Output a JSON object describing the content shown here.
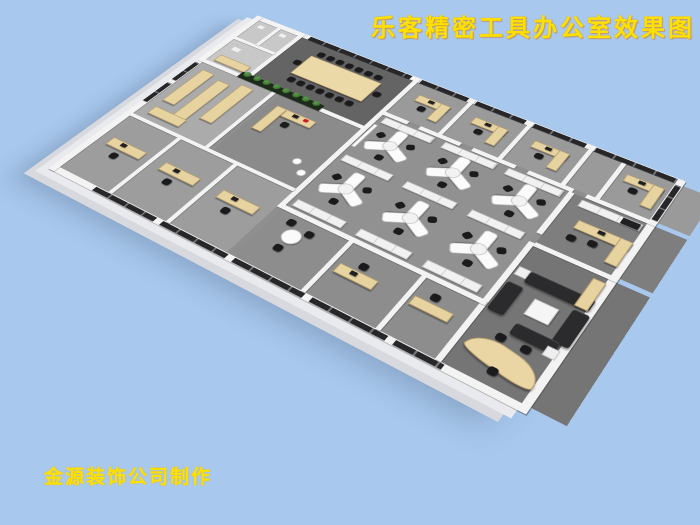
{
  "title": {
    "text": "乐客精密工具办公室效果图",
    "color": "#ffe100"
  },
  "credit": {
    "text": "金源装饰公司制作",
    "color": "#ffe100"
  },
  "palette": {
    "background": "#a8c8ed",
    "wall": "#f3f3f4",
    "floor": "#8f8f8f",
    "window_glass": "#27272a",
    "desk_wood": "#e7d3a0",
    "chair": "#1b1b1d",
    "sofa": "#2b2b2e",
    "plant_green": "#3f7d36",
    "accent_red": "#c81f1f",
    "text_yellow": "#ffe100"
  },
  "scene": {
    "rooms": [
      {
        "n": "restrooms",
        "x": 8,
        "y": 8,
        "w": 58,
        "h": 97,
        "c": "#c8c8c8"
      },
      {
        "n": "conference-room",
        "x": 72,
        "y": 8,
        "w": 153,
        "h": 97,
        "c": "#646464"
      },
      {
        "n": "ne-office-row",
        "x": 231,
        "y": 8,
        "w": 341,
        "h": 64,
        "c": "#9a9a9a"
      },
      {
        "n": "open-office",
        "x": 231,
        "y": 78,
        "w": 219,
        "h": 172,
        "c": "#919191"
      },
      {
        "n": "executive-office",
        "x": 456,
        "y": 78,
        "w": 116,
        "h": 82,
        "c": "#7e7e7e"
      },
      {
        "n": "lounge-reception",
        "x": 456,
        "y": 166,
        "w": 116,
        "h": 166,
        "c": "#757575"
      },
      {
        "n": "storage-room",
        "x": 8,
        "y": 111,
        "w": 100,
        "h": 114,
        "c": "#ababab"
      },
      {
        "n": "manager-office",
        "x": 118,
        "y": 111,
        "w": 107,
        "h": 114,
        "c": "#8b8b8b"
      },
      {
        "n": "sw-office-row",
        "x": 8,
        "y": 230,
        "w": 217,
        "h": 102,
        "c": "#9d9d9d"
      },
      {
        "n": "small-meeting-rooms",
        "x": 231,
        "y": 256,
        "w": 219,
        "h": 76,
        "c": "#8d8d8d"
      }
    ],
    "walls": [
      {
        "x": 0,
        "y": 0,
        "w": 540,
        "h": 8
      },
      {
        "x": 0,
        "y": 332,
        "w": 540,
        "h": 8
      },
      {
        "x": 0,
        "y": 0,
        "w": 8,
        "h": 340
      },
      {
        "x": 532,
        "y": 0,
        "w": 8,
        "h": 340
      },
      {
        "x": 66,
        "y": 0,
        "w": 6,
        "h": 105
      },
      {
        "x": 0,
        "y": 105,
        "w": 231,
        "h": 6
      },
      {
        "x": 225,
        "y": 0,
        "w": 6,
        "h": 256
      },
      {
        "x": 296,
        "y": 0,
        "w": 5,
        "h": 72
      },
      {
        "x": 367,
        "y": 0,
        "w": 5,
        "h": 72
      },
      {
        "x": 438,
        "y": 0,
        "w": 5,
        "h": 72
      },
      {
        "x": 475,
        "y": 0,
        "w": 5,
        "h": 72
      },
      {
        "x": 231,
        "y": 72,
        "w": 30,
        "h": 6
      },
      {
        "x": 275,
        "y": 72,
        "w": 50,
        "h": 6
      },
      {
        "x": 339,
        "y": 72,
        "w": 50,
        "h": 6
      },
      {
        "x": 403,
        "y": 72,
        "w": 50,
        "h": 6
      },
      {
        "x": 467,
        "y": 72,
        "w": 73,
        "h": 6
      },
      {
        "x": 450,
        "y": 78,
        "w": 6,
        "h": 70
      },
      {
        "x": 450,
        "y": 162,
        "w": 6,
        "h": 170
      },
      {
        "x": 456,
        "y": 160,
        "w": 84,
        "h": 6
      },
      {
        "x": 108,
        "y": 111,
        "w": 5,
        "h": 114
      },
      {
        "x": 8,
        "y": 225,
        "w": 217,
        "h": 5
      },
      {
        "x": 75,
        "y": 230,
        "w": 5,
        "h": 102
      },
      {
        "x": 150,
        "y": 230,
        "w": 5,
        "h": 102
      },
      {
        "x": 231,
        "y": 250,
        "w": 224,
        "h": 6
      },
      {
        "x": 310,
        "y": 256,
        "w": 5,
        "h": 76
      },
      {
        "x": 390,
        "y": 256,
        "w": 5,
        "h": 76
      },
      {
        "x": 8,
        "y": 50,
        "w": 58,
        "h": 5
      },
      {
        "x": 36,
        "y": 8,
        "w": 5,
        "h": 42
      }
    ],
    "windows": [
      {
        "x": 80,
        "y": 1,
        "w": 140,
        "h": 7
      },
      {
        "x": 233,
        "y": 1,
        "w": 60,
        "h": 7
      },
      {
        "x": 303,
        "y": 1,
        "w": 60,
        "h": 7
      },
      {
        "x": 373,
        "y": 1,
        "w": 60,
        "h": 7
      },
      {
        "x": 444,
        "y": 1,
        "w": 88,
        "h": 7
      },
      {
        "x": 533,
        "y": 10,
        "w": 6,
        "h": 60
      },
      {
        "x": 60,
        "y": 333,
        "w": 80,
        "h": 6
      },
      {
        "x": 148,
        "y": 333,
        "w": 80,
        "h": 6
      },
      {
        "x": 236,
        "y": 333,
        "w": 80,
        "h": 6
      },
      {
        "x": 324,
        "y": 333,
        "w": 80,
        "h": 6
      },
      {
        "x": 412,
        "y": 333,
        "w": 48,
        "h": 6
      },
      {
        "x": 1,
        "y": 115,
        "w": 6,
        "h": 40
      },
      {
        "x": 1,
        "y": 162,
        "w": 6,
        "h": 40
      }
    ],
    "furniture": [
      {
        "t": "ctable",
        "name": "conference-table",
        "x": 103,
        "y": 32,
        "w": 96,
        "h": 40
      },
      {
        "t": "chair",
        "x": 107,
        "y": 20
      },
      {
        "t": "chair",
        "x": 120,
        "y": 20
      },
      {
        "t": "chair",
        "x": 133,
        "y": 20
      },
      {
        "t": "chair",
        "x": 146,
        "y": 20
      },
      {
        "t": "chair",
        "x": 159,
        "y": 20
      },
      {
        "t": "chair",
        "x": 172,
        "y": 20
      },
      {
        "t": "chair",
        "x": 185,
        "y": 20
      },
      {
        "t": "chair",
        "x": 107,
        "y": 77
      },
      {
        "t": "chair",
        "x": 120,
        "y": 77
      },
      {
        "t": "chair",
        "x": 133,
        "y": 77
      },
      {
        "t": "chair",
        "x": 146,
        "y": 77
      },
      {
        "t": "chair",
        "x": 159,
        "y": 77
      },
      {
        "t": "chair",
        "x": 172,
        "y": 77
      },
      {
        "t": "chair",
        "x": 185,
        "y": 77
      },
      {
        "t": "chair",
        "x": 93,
        "y": 47
      },
      {
        "t": "chair",
        "x": 201,
        "y": 47
      },
      {
        "t": "desk",
        "x": 245,
        "y": 26,
        "w": 40,
        "h": 12
      },
      {
        "t": "desk",
        "x": 273,
        "y": 26,
        "w": 12,
        "h": 32
      },
      {
        "t": "chair",
        "x": 255,
        "y": 42
      },
      {
        "t": "darkbit",
        "x": 259,
        "y": 28,
        "w": 7,
        "h": 5
      },
      {
        "t": "desk",
        "x": 315,
        "y": 26,
        "w": 40,
        "h": 12
      },
      {
        "t": "desk",
        "x": 343,
        "y": 26,
        "w": 12,
        "h": 32
      },
      {
        "t": "chair",
        "x": 325,
        "y": 42
      },
      {
        "t": "darkbit",
        "x": 329,
        "y": 28,
        "w": 7,
        "h": 5
      },
      {
        "t": "desk",
        "x": 386,
        "y": 26,
        "w": 40,
        "h": 12
      },
      {
        "t": "desk",
        "x": 414,
        "y": 26,
        "w": 12,
        "h": 32
      },
      {
        "t": "chair",
        "x": 396,
        "y": 42
      },
      {
        "t": "darkbit",
        "x": 400,
        "y": 28,
        "w": 7,
        "h": 5
      },
      {
        "t": "desk",
        "x": 487,
        "y": 22,
        "w": 40,
        "h": 12
      },
      {
        "t": "desk",
        "x": 515,
        "y": 22,
        "w": 12,
        "h": 36
      },
      {
        "t": "chair",
        "x": 497,
        "y": 38
      },
      {
        "t": "darkbit",
        "x": 501,
        "y": 24,
        "w": 7,
        "h": 5
      },
      {
        "t": "cab",
        "x": 236,
        "y": 80,
        "w": 62,
        "h": 11
      },
      {
        "t": "cab",
        "x": 310,
        "y": 80,
        "w": 62,
        "h": 11
      },
      {
        "t": "cab",
        "x": 384,
        "y": 80,
        "w": 62,
        "h": 11
      },
      {
        "t": "board",
        "name": "whiteboard",
        "x": 232,
        "y": 96,
        "w": 5,
        "h": 44
      },
      {
        "t": "ydesk",
        "x": 266,
        "y": 118
      },
      {
        "t": "ydesk",
        "x": 341,
        "y": 118
      },
      {
        "t": "ydesk",
        "x": 416,
        "y": 118
      },
      {
        "t": "ydesk",
        "x": 266,
        "y": 198
      },
      {
        "t": "ydesk",
        "x": 341,
        "y": 198
      },
      {
        "t": "ydesk",
        "x": 416,
        "y": 198
      },
      {
        "t": "cab",
        "x": 236,
        "y": 154,
        "w": 58,
        "h": 11
      },
      {
        "t": "cab",
        "x": 310,
        "y": 154,
        "w": 58,
        "h": 11
      },
      {
        "t": "cab",
        "x": 384,
        "y": 154,
        "w": 58,
        "h": 11
      },
      {
        "t": "cab",
        "x": 236,
        "y": 236,
        "w": 58,
        "h": 11
      },
      {
        "t": "cab",
        "x": 310,
        "y": 236,
        "w": 58,
        "h": 11
      },
      {
        "t": "cab",
        "x": 384,
        "y": 236,
        "w": 58,
        "h": 11
      },
      {
        "t": "cab",
        "x": 466,
        "y": 82,
        "w": 64,
        "h": 11
      },
      {
        "t": "darkbit",
        "x": 510,
        "y": 83,
        "w": 18,
        "h": 9
      },
      {
        "t": "desk",
        "x": 476,
        "y": 110,
        "w": 56,
        "h": 13
      },
      {
        "t": "desk",
        "x": 519,
        "y": 110,
        "w": 13,
        "h": 38
      },
      {
        "t": "chair",
        "x": 496,
        "y": 128
      },
      {
        "t": "chair",
        "x": 476,
        "y": 132
      },
      {
        "t": "darkbit",
        "x": 498,
        "y": 112,
        "w": 7,
        "h": 5
      },
      {
        "t": "sofa",
        "name": "sofa-3seat",
        "x": 470,
        "y": 196,
        "w": 64,
        "h": 16
      },
      {
        "t": "sofa",
        "name": "sofa-side",
        "x": 458,
        "y": 218,
        "w": 16,
        "h": 40
      },
      {
        "t": "sofa",
        "name": "sofa-side",
        "x": 522,
        "y": 216,
        "w": 16,
        "h": 44
      },
      {
        "t": "sofa",
        "name": "sofa-2seat",
        "x": 488,
        "y": 258,
        "w": 42,
        "h": 15
      },
      {
        "t": "ctab",
        "name": "coffee-table",
        "x": 488,
        "y": 224,
        "w": 24,
        "h": 22
      },
      {
        "t": "side",
        "x": 458,
        "y": 196,
        "w": 12,
        "h": 12
      },
      {
        "t": "side",
        "x": 522,
        "y": 266,
        "w": 12,
        "h": 12
      },
      {
        "t": "desk",
        "name": "tall-cabinet",
        "x": 520,
        "y": 172,
        "w": 13,
        "h": 40
      },
      {
        "t": "curve",
        "name": "reception-desk",
        "x": 462,
        "y": 288,
        "w": 72,
        "h": 27
      },
      {
        "t": "chair",
        "x": 480,
        "y": 276
      },
      {
        "t": "chair",
        "x": 504,
        "y": 276
      },
      {
        "t": "chair",
        "x": 492,
        "y": 312
      },
      {
        "t": "desk",
        "name": "shelf",
        "x": 18,
        "y": 122,
        "w": 17,
        "h": 68
      },
      {
        "t": "desk",
        "name": "shelf",
        "x": 45,
        "y": 128,
        "w": 17,
        "h": 78
      },
      {
        "t": "desk",
        "name": "shelf",
        "x": 72,
        "y": 120,
        "w": 17,
        "h": 72
      },
      {
        "t": "desk",
        "name": "work-table",
        "x": 20,
        "y": 202,
        "w": 44,
        "h": 14
      },
      {
        "t": "desk",
        "name": "sideboard",
        "x": 16,
        "y": 88,
        "w": 44,
        "h": 13
      },
      {
        "t": "planter",
        "name": "plant-row",
        "x": 58,
        "y": 100,
        "w": 112,
        "h": 11
      },
      {
        "t": "desk",
        "x": 128,
        "y": 128,
        "w": 52,
        "h": 13
      },
      {
        "t": "desk",
        "x": 128,
        "y": 128,
        "w": 13,
        "h": 46
      },
      {
        "t": "chair",
        "x": 150,
        "y": 146
      },
      {
        "t": "accent",
        "name": "red-accent",
        "x": 166,
        "y": 130,
        "w": 6,
        "h": 5
      },
      {
        "t": "darkbit",
        "x": 152,
        "y": 130,
        "w": 7,
        "h": 5
      },
      {
        "t": "stool",
        "x": 196,
        "y": 186
      },
      {
        "t": "stool",
        "x": 210,
        "y": 198
      },
      {
        "t": "desk",
        "x": 20,
        "y": 266,
        "w": 46,
        "h": 13
      },
      {
        "t": "chair",
        "x": 36,
        "y": 284
      },
      {
        "t": "darkbit",
        "x": 34,
        "y": 268,
        "w": 7,
        "h": 5
      },
      {
        "t": "desk",
        "x": 92,
        "y": 266,
        "w": 46,
        "h": 13
      },
      {
        "t": "chair",
        "x": 108,
        "y": 284
      },
      {
        "t": "darkbit",
        "x": 106,
        "y": 268,
        "w": 7,
        "h": 5
      },
      {
        "t": "desk",
        "x": 167,
        "y": 266,
        "w": 46,
        "h": 13
      },
      {
        "t": "chair",
        "x": 183,
        "y": 284
      },
      {
        "t": "darkbit",
        "x": 181,
        "y": 268,
        "w": 7,
        "h": 5
      },
      {
        "t": "round",
        "name": "round-table",
        "x": 252,
        "y": 272,
        "w": 20,
        "h": 20
      },
      {
        "t": "chair",
        "x": 246,
        "y": 262
      },
      {
        "t": "chair",
        "x": 270,
        "y": 266
      },
      {
        "t": "chair",
        "x": 256,
        "y": 296
      },
      {
        "t": "desk",
        "x": 320,
        "y": 284,
        "w": 42,
        "h": 13
      },
      {
        "t": "chair",
        "x": 336,
        "y": 272
      },
      {
        "t": "darkbit",
        "x": 334,
        "y": 286,
        "w": 7,
        "h": 5
      },
      {
        "t": "desk",
        "x": 398,
        "y": 280,
        "w": 40,
        "h": 12
      },
      {
        "t": "chair",
        "x": 410,
        "y": 268
      },
      {
        "t": "side",
        "name": "wc-fixture",
        "x": 14,
        "y": 14,
        "w": 10,
        "h": 8
      },
      {
        "t": "side",
        "name": "wc-fixture",
        "x": 46,
        "y": 14,
        "w": 10,
        "h": 8
      },
      {
        "t": "side",
        "name": "wc-fixture",
        "x": 18,
        "y": 66,
        "w": 12,
        "h": 9
      }
    ]
  }
}
